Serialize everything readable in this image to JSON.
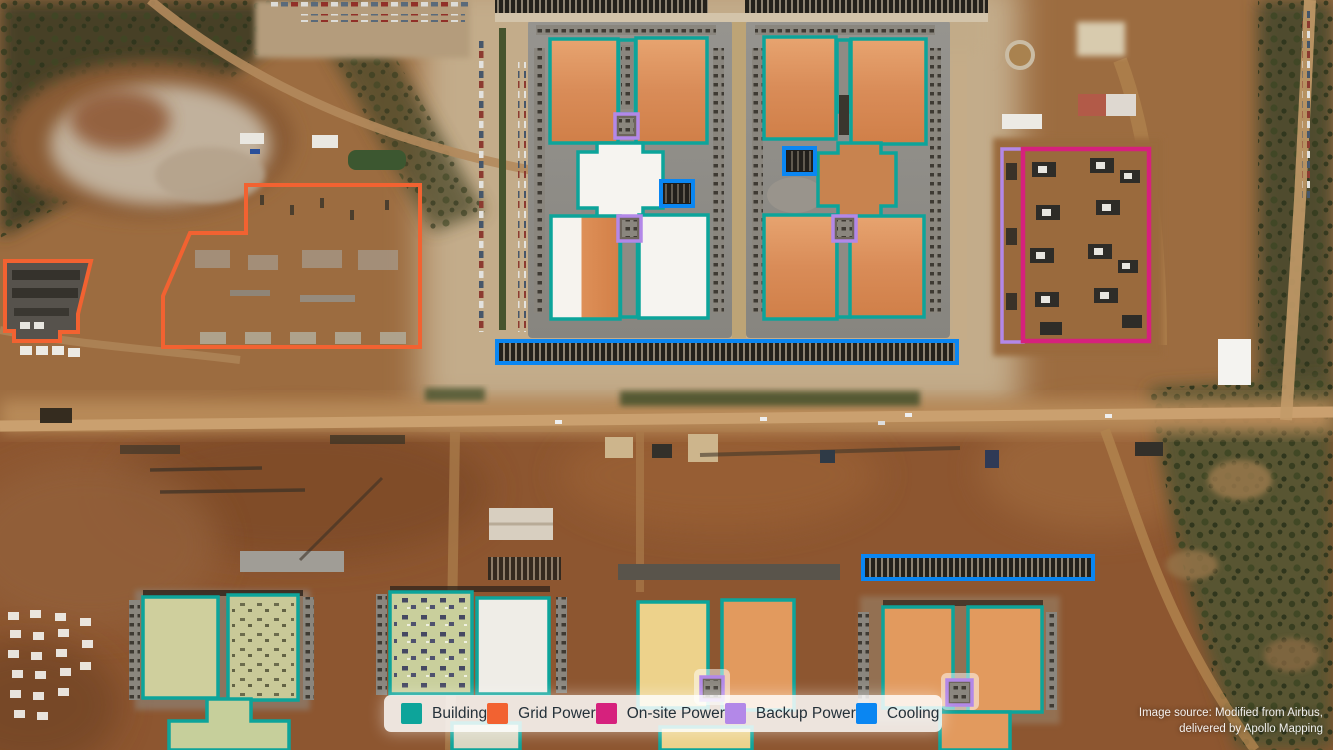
{
  "legend": {
    "items": [
      {
        "key": "building",
        "label": "Building",
        "color": "#0DA49A"
      },
      {
        "key": "grid",
        "label": "Grid Power",
        "color": "#F26231"
      },
      {
        "key": "onsite",
        "label": "On-site Power",
        "color": "#D6217D"
      },
      {
        "key": "backup",
        "label": "Backup Power",
        "color": "#B388E8"
      },
      {
        "key": "cooling",
        "label": "Cooling",
        "color": "#0A86F2"
      }
    ]
  },
  "attribution": {
    "line1": "Image source: Modified from Airbus,",
    "line2": "delivered by Apollo Mapping"
  }
}
